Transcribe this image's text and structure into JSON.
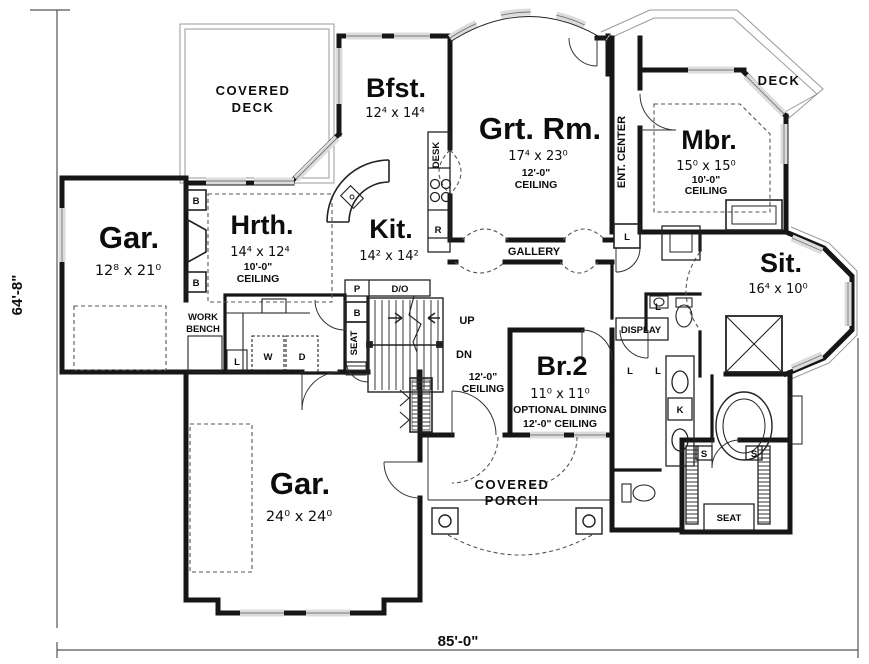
{
  "plan": {
    "overall_width": "85'-0\"",
    "overall_height": "64'-8\"",
    "rooms": {
      "covered_deck": {
        "line1": "COVERED",
        "line2": "DECK"
      },
      "bfst": {
        "name": "Bfst.",
        "size": "12⁴ x 14⁴"
      },
      "grt_rm": {
        "name": "Grt. Rm.",
        "size": "17⁴ x 23⁰",
        "ceiling1": "12'-0\"",
        "ceiling2": "CEILING"
      },
      "deck": {
        "name": "DECK"
      },
      "mbr": {
        "name": "Mbr.",
        "size": "15⁰ x 15⁰",
        "ceiling1": "10'-0\"",
        "ceiling2": "CEILING"
      },
      "ent_center": {
        "name": "ENT. CENTER"
      },
      "gar_upper": {
        "name": "Gar.",
        "size": "12⁸ x 21⁰"
      },
      "hrth": {
        "name": "Hrth.",
        "size": "14⁴ x 12⁴",
        "ceiling1": "10'-0\"",
        "ceiling2": "CEILING"
      },
      "kit": {
        "name": "Kit.",
        "size": "14² x 14²"
      },
      "gallery": {
        "name": "GALLERY"
      },
      "sit": {
        "name": "Sit.",
        "size": "16⁴ x 10⁰"
      },
      "br2": {
        "name": "Br.2",
        "size": "11⁰ x 11⁰",
        "note1": "OPTIONAL DINING",
        "note2": "12'-0\" CEILING"
      },
      "stair_hall": {
        "ceiling1": "12'-0\"",
        "ceiling2": "CEILING"
      },
      "gar_lower": {
        "name": "Gar.",
        "size": "24⁰ x 24⁰"
      },
      "covered_porch": {
        "line1": "COVERED",
        "line2": "PORCH"
      },
      "work_bench": {
        "line1": "WORK",
        "line2": "BENCH"
      }
    },
    "annotations": {
      "up": "UP",
      "dn": "DN",
      "desk": "DESK",
      "display": "DISPLAY",
      "seat": "SEAT"
    },
    "tags": {
      "b": "B",
      "r": "R",
      "p": "P",
      "d_o": "D/O",
      "w": "W",
      "d": "D",
      "l": "L",
      "k": "K",
      "s": "S"
    },
    "colors": {
      "wall": "#161616",
      "background": "#ffffff",
      "window": "#dcdcdc"
    }
  }
}
